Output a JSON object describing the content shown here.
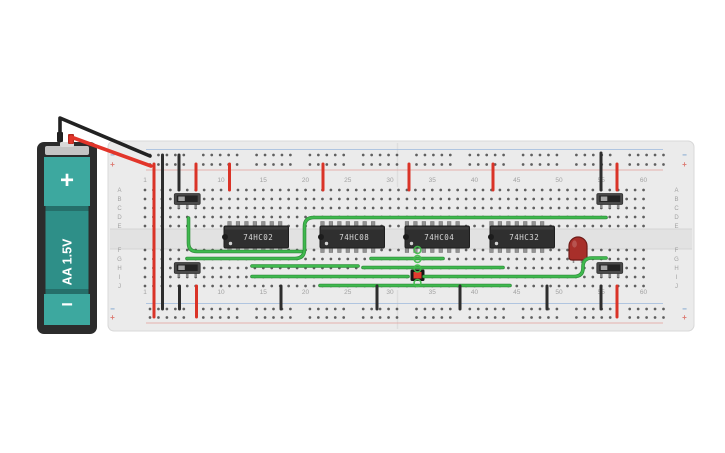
{
  "title": "breadboard-logic-circuit",
  "colors": {
    "board": "#ebebeb",
    "board_edge": "#d8d8d8",
    "channel": "#e2e2e2",
    "channel_line": "#d4d4d4",
    "hole": "#3c3c3c",
    "label": "#a2a2a2",
    "seam": "#dedede",
    "rail_blue_line": "#9db9dd",
    "rail_red_line": "#e5a09a",
    "bus_minus_color": "#7aa3cf",
    "bus_plus_color": "#dc7a72",
    "wire_green": "#3fb94e",
    "wire_green_dark": "#2e8a39",
    "wire_red": "#da3327",
    "wire_black": "#2d2d2d",
    "chip_body": "#2f2f2f",
    "chip_edge": "#1e1e1e",
    "chip_text": "#d8d8d8",
    "chip_pin": "#939393",
    "switch_body": "#4a4a4a",
    "switch_inner": "#242424",
    "switch_knob": "#a5a5a5",
    "switch_pin": "#8a8a8a",
    "led_body": "#a82f2a",
    "led_edge": "#6e1b18",
    "led_leg": "#8f8f8f",
    "button_case": "#161616",
    "button_cap": "#e23b2e",
    "battery_case": "#2c2c2c",
    "battery_plate": "#c4c4c4",
    "battery_nub": "#d9d9d9",
    "battery_teal": "#3da89f",
    "battery_teal_mid": "#2e8f88",
    "battery_teal_dark": "#256f6a",
    "highlight_ring": "#44bb4e"
  },
  "breadboard": {
    "x": 108,
    "y": 141,
    "w": 586,
    "h": 190,
    "col0_x": 145,
    "col_pitch": 8.45,
    "num_cols": 60,
    "rows_top_y": [
      190,
      199,
      208,
      217,
      226
    ],
    "rows_bottom_y": [
      250,
      259,
      268,
      277,
      286
    ],
    "row_letters_top": [
      "A",
      "B",
      "C",
      "D",
      "E"
    ],
    "row_letters_bottom": [
      "F",
      "G",
      "H",
      "I",
      "J"
    ],
    "letter_x_left": 119.5,
    "letter_x_right": 676.5,
    "col_labels": [
      "1",
      "10",
      "15",
      "20",
      "25",
      "30",
      "35",
      "40",
      "45",
      "50",
      "55",
      "60"
    ],
    "col_label_cols": [
      1,
      10,
      15,
      20,
      25,
      30,
      35,
      40,
      45,
      50,
      55,
      60
    ],
    "col_label_y_top": 182,
    "col_label_y_bottom": 294,
    "bus": {
      "minus": "−",
      "plus": "+",
      "top_minus_y": 155,
      "top_plus_y": 164.5,
      "bottom_minus_y": 309,
      "bottom_plus_y": 317.5,
      "dot_start_x": 150,
      "group_pitch": 53.3,
      "dot_pitch": 8.45,
      "groups": 10,
      "symbol_x_left": 112.5,
      "symbol_x_right": 684.5,
      "line_x1": 146,
      "line_x2": 663,
      "top_blue_line_y": 149.5,
      "top_red_line_y": 170,
      "bottom_blue_line_y": 303.5,
      "bottom_red_line_y": 323
    },
    "channel": {
      "y": 229,
      "h": 20
    },
    "seam_x": 397.5
  },
  "battery": {
    "label": "AA 1.5V",
    "plus": "+",
    "minus": "−",
    "case": {
      "x": 37,
      "y": 142,
      "w": 60,
      "h": 192
    },
    "inner": {
      "x": 44,
      "y": 157,
      "w": 46,
      "h": 168
    },
    "top_section_h": 49,
    "bottom_section_h": 31,
    "shoulder_h": 5,
    "plate": {
      "x": 45,
      "y": 146,
      "w": 44,
      "h": 9
    },
    "nub": {
      "x": 60,
      "y": 142,
      "w": 14,
      "h": 5
    },
    "stub_black": {
      "x": 57,
      "y": 132,
      "w": 6,
      "h": 10
    },
    "stub_red": {
      "x": 68,
      "y": 134,
      "w": 6,
      "h": 10
    },
    "lead_black_path": "M60,140 L60,118 L150,156",
    "lead_red_path": "M71,142 L71,137 L151,166"
  },
  "chips": [
    {
      "label": "74HC02",
      "x": 224,
      "start_col": 11
    },
    {
      "label": "74HC08",
      "x": 320,
      "start_col": 22
    },
    {
      "label": "74HC04",
      "x": 405,
      "start_col": 32
    },
    {
      "label": "74HC32",
      "x": 490,
      "start_col": 42
    }
  ],
  "chip_geom": {
    "y": 226,
    "w": 64.5,
    "h": 22,
    "pins_per_side": 7,
    "pin_w": 3.6,
    "pin_h": 5.5
  },
  "switches": [
    {
      "name": "slide-switch-top-left",
      "pin_cols": [
        5,
        6,
        7
      ],
      "body_y": 193.5
    },
    {
      "name": "slide-switch-top-right",
      "pin_cols": [
        55,
        56,
        57
      ],
      "body_y": 193.5
    },
    {
      "name": "slide-switch-bottom-left",
      "pin_cols": [
        5,
        6,
        7
      ],
      "body_y": 262.5
    },
    {
      "name": "slide-switch-bottom-right",
      "pin_cols": [
        55,
        56,
        57
      ],
      "body_y": 262.5
    }
  ],
  "switch_geom": {
    "h": 11,
    "pad": 4.5,
    "pin_h": 4.5
  },
  "pushbutton": {
    "x": 410.5,
    "y": 269.5,
    "w": 14,
    "h": 11.5,
    "inset": 3
  },
  "led": {
    "x": 569,
    "y": 237,
    "w": 18,
    "h": 23,
    "leg_xs": [
      573.5,
      581.5
    ],
    "leg_y1": 256,
    "leg_y2": 263
  },
  "wires": {
    "green_paths": [
      "M188.5,218 L188.5,243 Q188.5,251.5 197,251.5 L302,251.5",
      "M187,258.5 L295,258.5 Q304.5,258.5 304.5,249 L304.5,226.5 Q304.5,217.5 314,217.5 L606,217.5",
      "M252,266 L358,266",
      "M363,267.5 L503,267.5",
      "M252,276.5 L408,276.5",
      "M424,276.5 L574,276.5 Q583,276.5 583,268 L583,266.5 Q583,258 592,258 L606,258",
      "M320,285.5 L510,285.5",
      "M371,258.5 L443,258.5"
    ],
    "black_vertical": [
      {
        "x": 179,
        "y1": 155,
        "y2": 190
      },
      {
        "x": 601,
        "y1": 153,
        "y2": 190
      },
      {
        "x": 162.5,
        "y1": 155,
        "y2": 309
      },
      {
        "x": 179.5,
        "y1": 286,
        "y2": 309
      },
      {
        "x": 281,
        "y1": 286,
        "y2": 309
      },
      {
        "x": 377,
        "y1": 286,
        "y2": 309
      },
      {
        "x": 460,
        "y1": 286,
        "y2": 309
      },
      {
        "x": 547,
        "y1": 286,
        "y2": 309
      },
      {
        "x": 601,
        "y1": 286,
        "y2": 309
      }
    ],
    "red_vertical": [
      {
        "x": 196,
        "y1": 164,
        "y2": 190
      },
      {
        "x": 229.5,
        "y1": 164,
        "y2": 190
      },
      {
        "x": 323,
        "y1": 164,
        "y2": 190
      },
      {
        "x": 409,
        "y1": 164,
        "y2": 190
      },
      {
        "x": 493,
        "y1": 164,
        "y2": 190
      },
      {
        "x": 617,
        "y1": 164,
        "y2": 190
      },
      {
        "x": 154,
        "y1": 164,
        "y2": 317
      },
      {
        "x": 196.5,
        "y1": 286,
        "y2": 317
      },
      {
        "x": 617,
        "y1": 286,
        "y2": 317
      }
    ]
  },
  "highlights": [
    {
      "x": 417.5,
      "y": 250
    },
    {
      "x": 417.5,
      "y": 259
    },
    {
      "x": 417.5,
      "y": 268.5
    },
    {
      "x": 417.5,
      "y": 283
    }
  ]
}
